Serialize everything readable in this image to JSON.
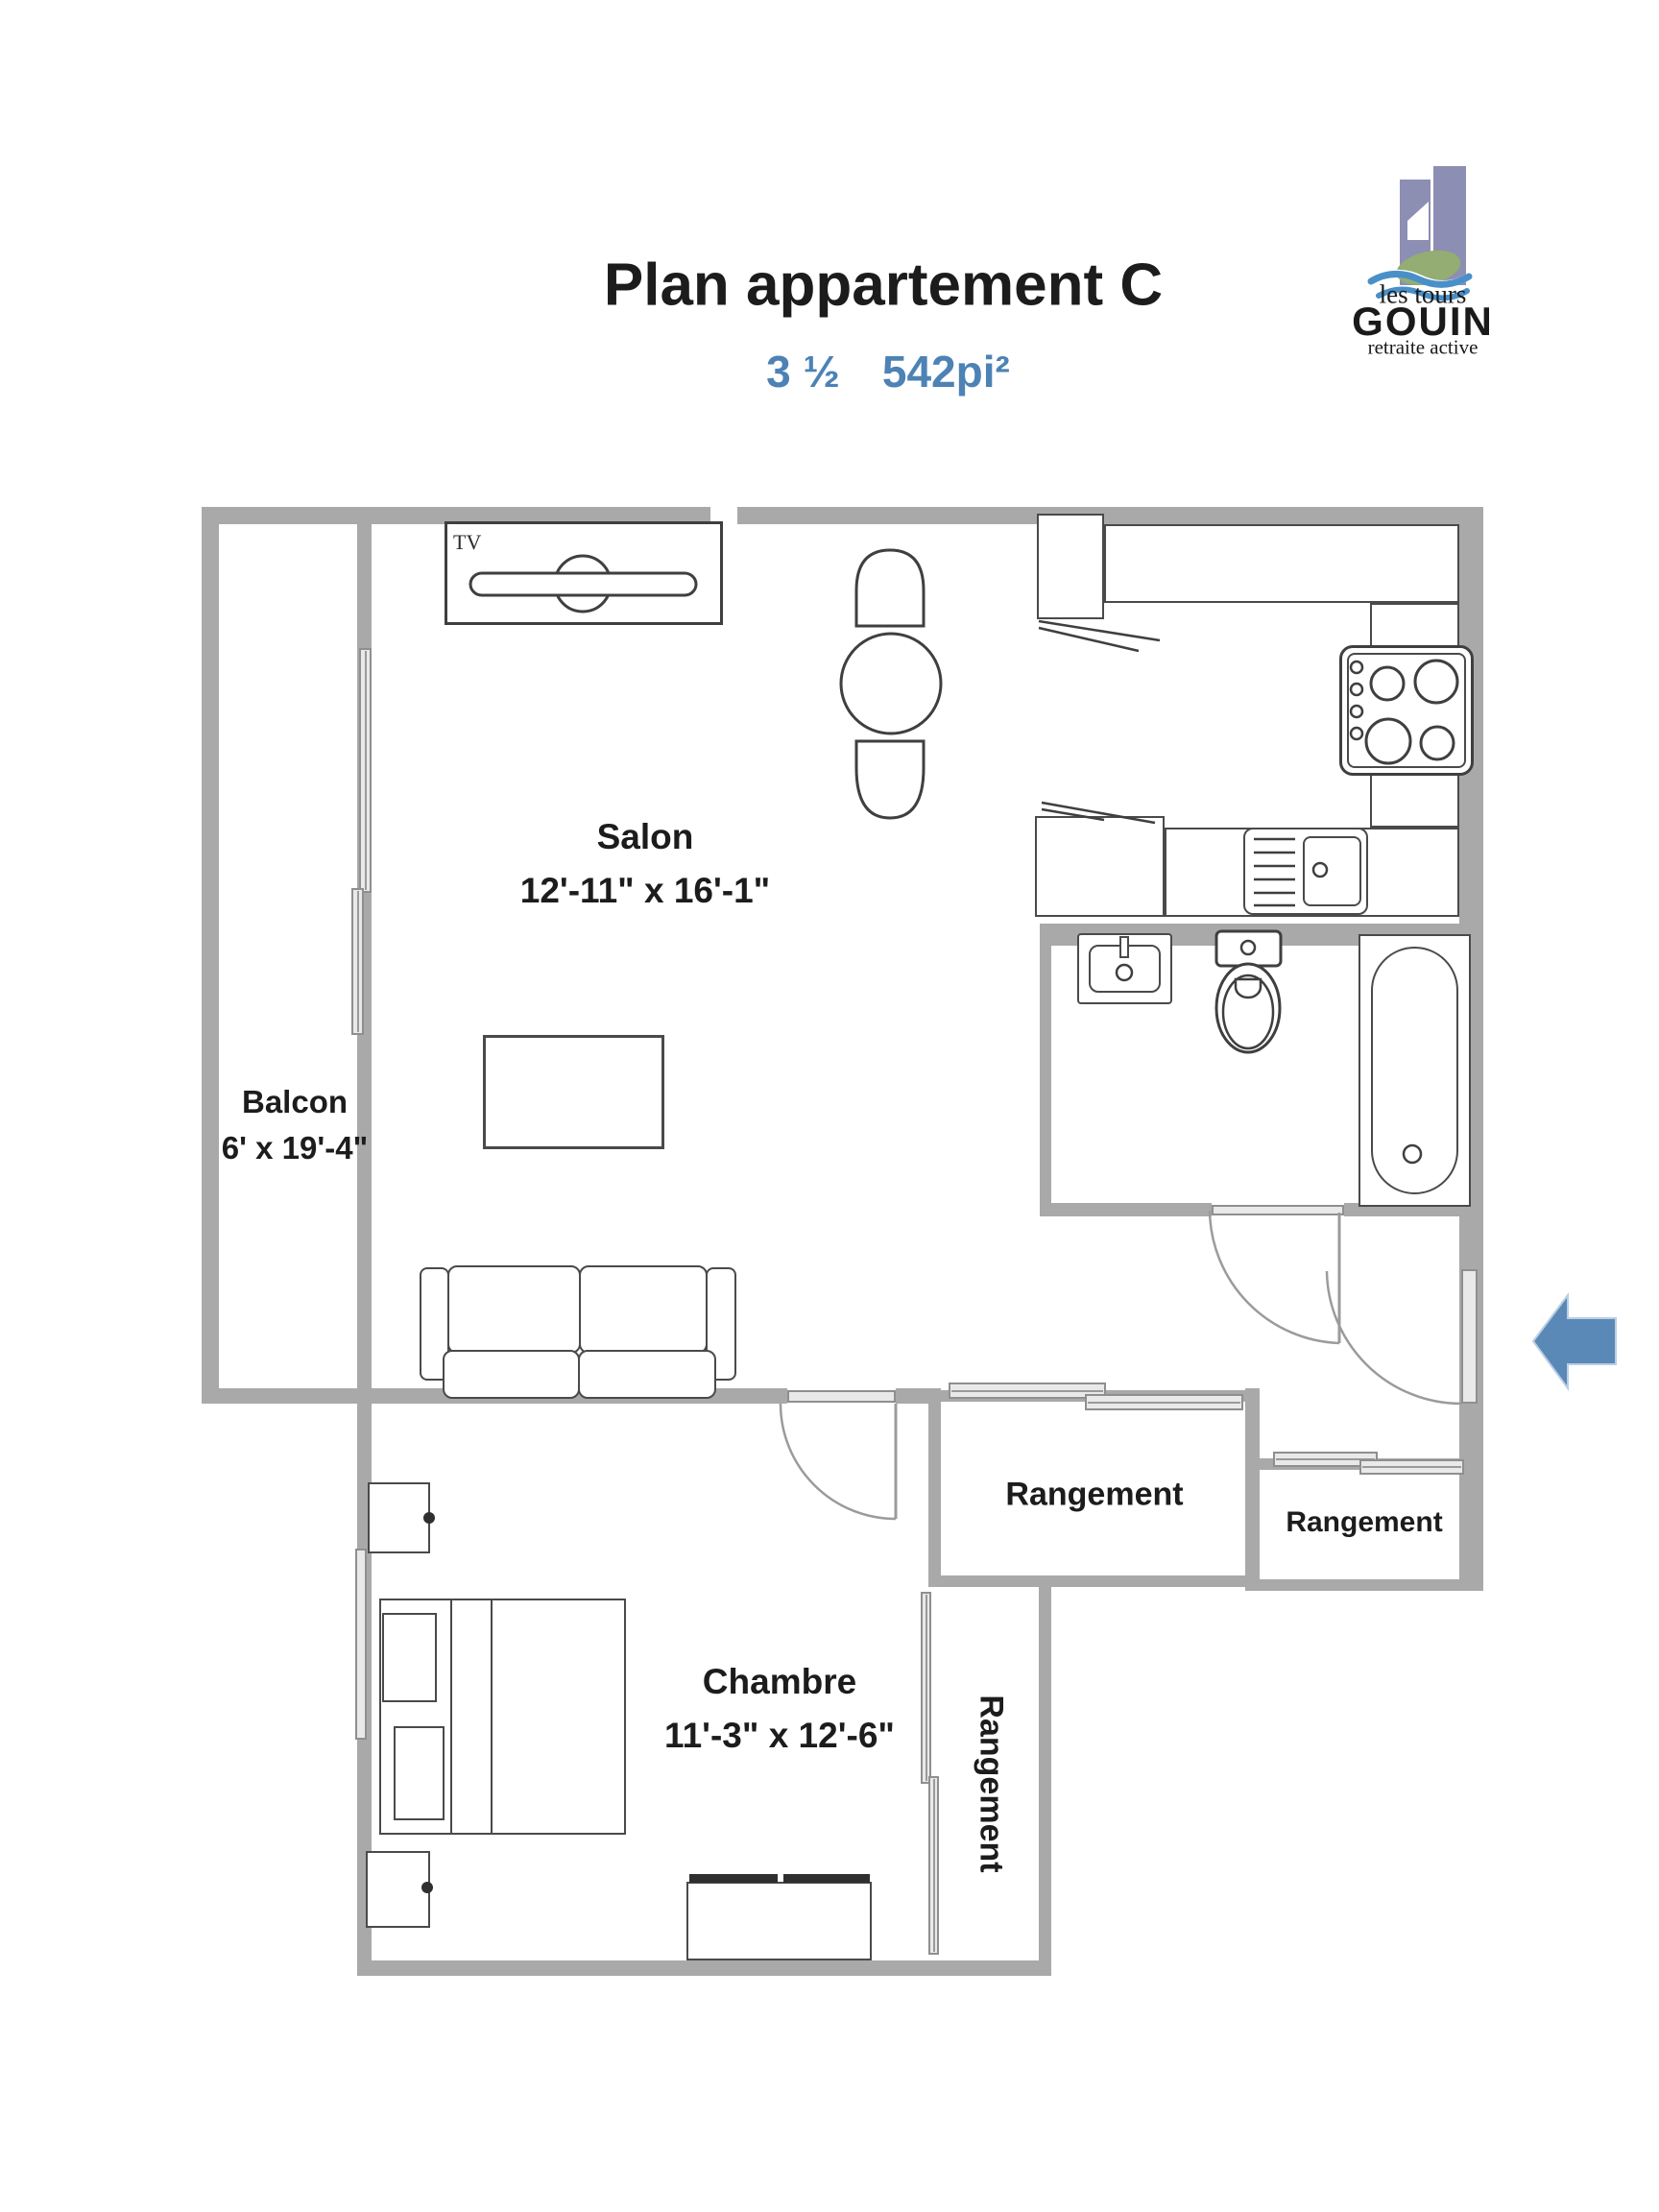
{
  "header": {
    "title": "Plan appartement C",
    "unit_size": "3 ½",
    "area": "542pi²"
  },
  "logo": {
    "top": "les tours",
    "name": "GOUIN",
    "tagline": "retraite active"
  },
  "rooms": {
    "salon": {
      "name": "Salon",
      "dims": "12'-11\" x 16'-1\""
    },
    "balcon": {
      "name": "Balcon",
      "dims": "6' x 19'-4\""
    },
    "chambre": {
      "name": "Chambre",
      "dims": "11'-3\" x 12'-6\""
    },
    "rangement_hall": {
      "name": "Rangement"
    },
    "rangement_entry": {
      "name": "Rangement"
    },
    "rangement_bedroom": {
      "name": "Rangement"
    }
  },
  "labels": {
    "tv": "TV"
  },
  "colors": {
    "wall": "#a9a9a9",
    "panel": "#e9e9e9",
    "line": "#3f3f3f",
    "accent_blue": "#4d82b5",
    "arrow_blue": "#5b89b7",
    "logo_purple": "#8d8eb3",
    "logo_green": "#93ad72",
    "logo_wave": "#4a90c8"
  }
}
